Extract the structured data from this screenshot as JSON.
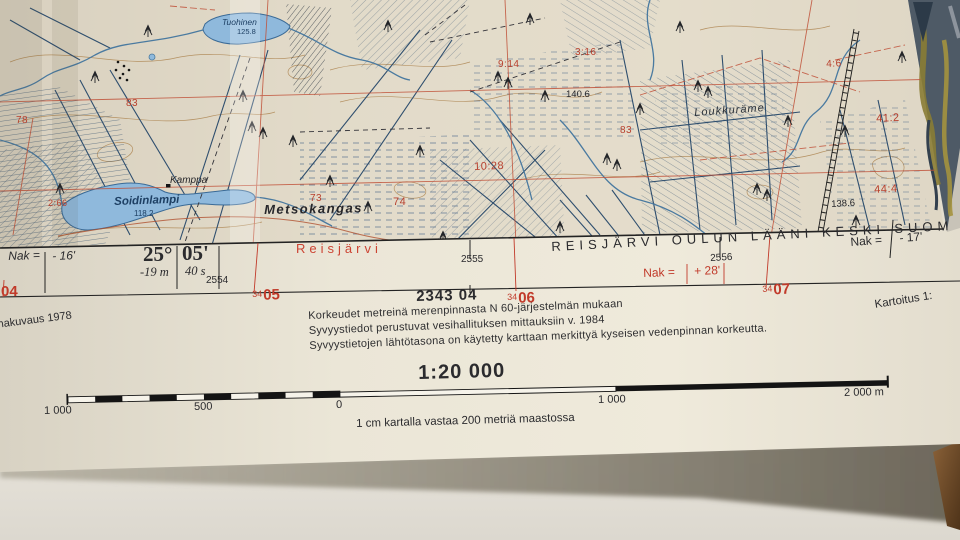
{
  "map_area": {
    "labels_red": [
      {
        "text": "78"
      },
      {
        "text": "83"
      },
      {
        "text": "2:66"
      },
      {
        "text": "73"
      },
      {
        "text": "74"
      },
      {
        "text": "10:28"
      },
      {
        "text": "9:14"
      },
      {
        "text": "3:16"
      },
      {
        "text": "83"
      },
      {
        "text": "4:6"
      },
      {
        "text": "41:2"
      },
      {
        "text": "44:4"
      }
    ],
    "labels_black": [
      {
        "text": "Kamppa"
      },
      {
        "text": "140.6"
      },
      {
        "text": "138.6"
      },
      {
        "text": "Metsokangas"
      },
      {
        "text": "Loukkuräme"
      }
    ],
    "labels_water": [
      {
        "text": "Tuohinen"
      },
      {
        "text": "125.8"
      },
      {
        "text": "Soidinlampi"
      },
      {
        "text": "118.2"
      }
    ]
  },
  "margin": {
    "left": {
      "nak_label": "Nak =",
      "nak_value": "- 16'",
      "deg": "25°",
      "min": "05'",
      "deg_corr": "-19 m",
      "min_corr": "40 s",
      "grid": "2554"
    },
    "center": {
      "sheet_name": "Reisjärvi",
      "grid": "2555"
    },
    "right": {
      "adjoining": "REISJÄRVI OULUN LÄÄNI KESKI-SUOM",
      "grid": "2556",
      "nak_red_label": "Nak =",
      "nak_red_value": "+ 28'",
      "nak_label": "Nak =",
      "nak_value": "- 17'"
    }
  },
  "below": {
    "grid_refs": [
      {
        "small": "34",
        "big": "04"
      },
      {
        "small": "34",
        "big": "05"
      },
      {
        "small": "34",
        "big": "06"
      },
      {
        "small": "34",
        "big": "07"
      }
    ],
    "sheet_number": "2343 04",
    "photo_note": "makuvaus 1978",
    "survey_note": "Kartoitus 1:",
    "notes": [
      "Korkeudet metreinä merenpinnasta N 60-järjestelmän mukaan",
      "Syvyystiedot perustuvat vesihallituksen mittauksiin v. 1984",
      "Syvyystietojen lähtötasona on käytetty karttaan merkittyä kyseisen vedenpinnan korkeutta."
    ]
  },
  "scale": {
    "ratio": "1:20 000",
    "labels": [
      "1 000",
      "500",
      "0",
      "1 000",
      "2 000 m"
    ],
    "caption": "1 cm kartalla vastaa 200 metriä maastossa"
  },
  "colors": {
    "paper": "#ece7d8",
    "map_red": "#b8402e",
    "water": "#8fb9dc",
    "ditch": "#2e4e6e",
    "contour": "#b08a58",
    "ink": "#1f1f1f"
  }
}
